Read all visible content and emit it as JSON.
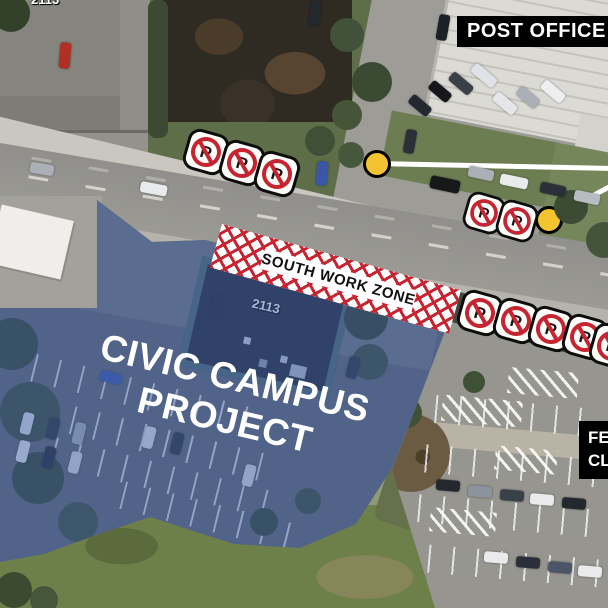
{
  "labels": {
    "post_office": "POST OFFICE",
    "south_work_zone": "SOUTH WORK ZONE",
    "civic_campus_line1": "CIVIC CAMPUS",
    "civic_campus_line2": "PROJECT",
    "clipped_right_line1": "FE",
    "clipped_right_line2": "CL",
    "building_number": "2113",
    "building_number_top_edge": "2113"
  },
  "icons": {
    "no_parking_letter": "P",
    "no_parking_icon": "no-parking-sign-icon",
    "marker_icon": "yellow-circle-marker-icon"
  },
  "markers": {
    "count": 2,
    "fill_color": "#F4C430",
    "border_color": "#000000",
    "callout_line_color": "#FFFFFF"
  },
  "signs": {
    "groups": [
      {
        "name": "north-roadside",
        "count": 3
      },
      {
        "name": "mid-roadside",
        "count": 2
      },
      {
        "name": "south-roadside",
        "count": 5
      }
    ]
  },
  "colors": {
    "overlay_blue": "#3C5CA8",
    "work_zone_red": "#C62430",
    "label_bg": "#000000",
    "label_text": "#FFFFFF",
    "project_text": "#FFFFFF",
    "work_zone_text": "#111111"
  }
}
